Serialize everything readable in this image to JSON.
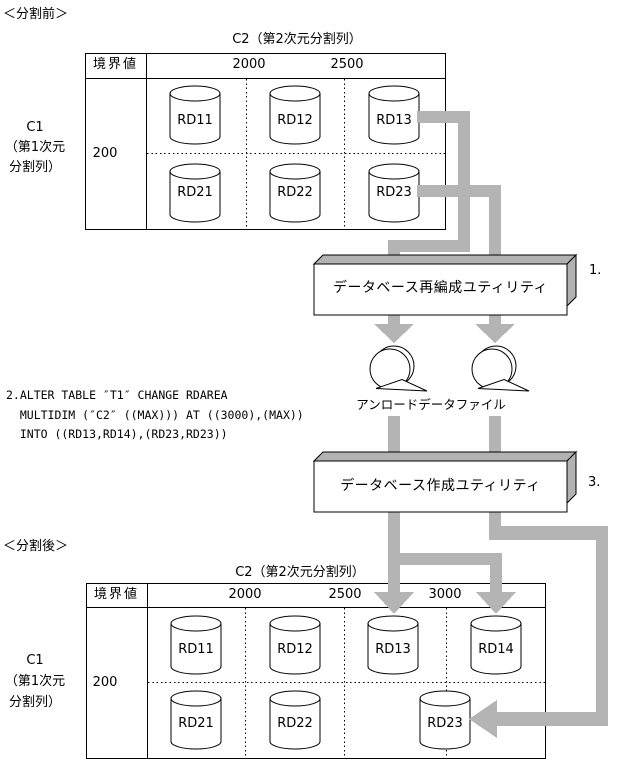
{
  "page": {
    "before_label": "＜分割前＞",
    "after_label": "＜分割後＞"
  },
  "sql_note": "2.ALTER TABLE ″T1″ CHANGE RDAREA\n  MULTIDIM (″C2″ ((MAX))) AT ((3000),(MAX))\n  INTO ((RD13,RD14),(RD23,RD23))",
  "flow": {
    "step1_no": "1.",
    "reorg_box": "データベース再編成ユティリティ",
    "unload_files": "アンロードデータファイル",
    "step3_no": "3.",
    "create_box": "データベース作成ユティリティ"
  },
  "before_table": {
    "title": "C2（第2次元分割列）",
    "boundary_header": "境界値",
    "col_boundaries": [
      "2000",
      "2500"
    ],
    "row_header": "C1\n（第1次元\n分割列）",
    "row_boundary": "200",
    "row1": [
      "RD11",
      "RD12",
      "RD13"
    ],
    "row2": [
      "RD21",
      "RD22",
      "RD23"
    ]
  },
  "after_table": {
    "title": "C2（第2次元分割列）",
    "boundary_header": "境界値",
    "col_boundaries": [
      "2000",
      "2500",
      "3000"
    ],
    "row_header": "C1\n（第1次元\n分割列）",
    "row_boundary": "200",
    "row1": [
      "RD11",
      "RD12",
      "RD13",
      "RD14"
    ],
    "row2": [
      "RD21",
      "RD22",
      "RD23"
    ]
  },
  "colors": {
    "arrow_gray": "#b4b4b4",
    "box_gray": "#b2b2b2",
    "line_black": "#000000"
  }
}
